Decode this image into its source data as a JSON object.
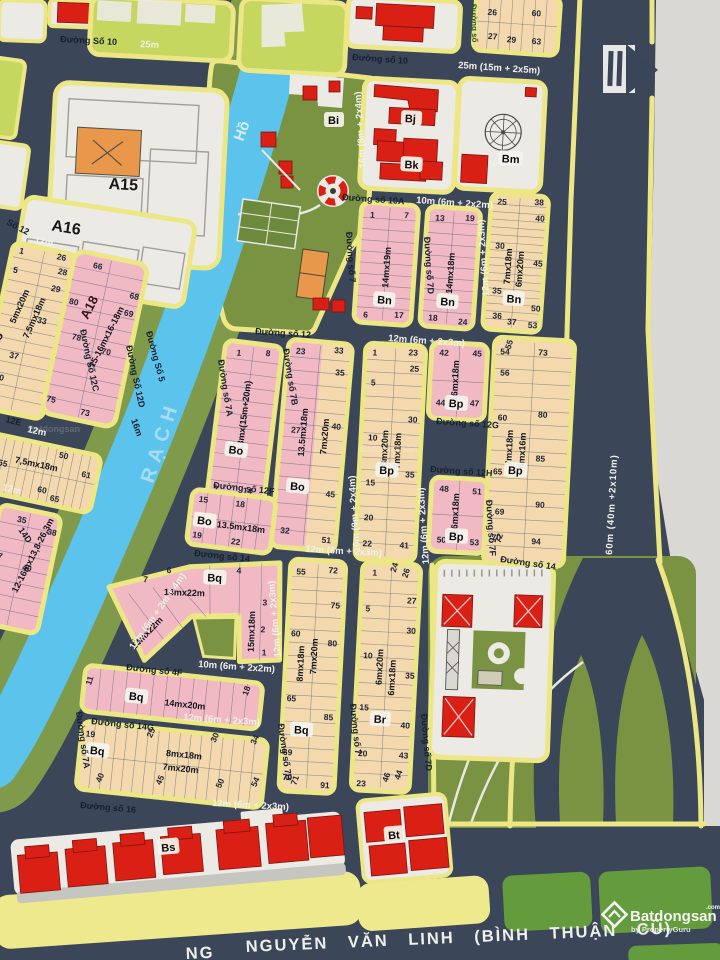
{
  "streets": {
    "s10": "Đường Số 10",
    "s10m": "Đường số 10",
    "s10A": "Đường số 10A",
    "s12": "Đường số 12",
    "s12C": "Đường Số 12C",
    "s12D": "Đường Số 12D",
    "s12E": "12E",
    "s12F": "Đường số 12F",
    "s12G": "Đường số 12G",
    "s12H": "Đường số 12H",
    "s14": "Đường số 14",
    "s14D": "14D",
    "s14G": "Đường số 14G",
    "s16": "Đường số 16",
    "s4F": "Đường số 4F",
    "s5": "Đường Số 5",
    "s7": "Đường số 7",
    "s7A": "Đường số 7A",
    "s7B": "Đường số 7B",
    "s7D": "Đường số 7D",
    "s7F": "Đường số 7F",
    "s9": "Đường số",
    "so12": "Số 12"
  },
  "widths": {
    "w25": "25m",
    "w25s": "25m (15m + 2x5m)",
    "w10": "10m (6m + 2x2m)",
    "w12s": "12m (6m + 2x3m)",
    "w16s": "16m (8m + 2x4m)",
    "w12r": "12m (6m + 2m + 4m)",
    "w12": "12m",
    "w16": "16m",
    "w60": "60m (40m +2x10m)"
  },
  "river": {
    "rach": "RẠCH",
    "ho": "Hồ"
  },
  "avenue": {
    "prefix": "NG",
    "name": "NGUYỄN VĂN LINH (BÌNH THUẬN CŨ)"
  },
  "watermark": {
    "brand": "Batdongsan",
    "tld": ".com.vn",
    "byline": "by PropertyGuru"
  },
  "colors": {
    "road": "#3b4759",
    "border": "#ece685",
    "pink": "#f0b9c3",
    "tan": "#f3d9ad",
    "water": "#5cc3ec",
    "park": "#7a9342",
    "red": "#da1f14",
    "gray": "#d9d8d4"
  },
  "blocks": {
    "a15": {
      "label": "A15"
    },
    "a16": {
      "label": "A16"
    },
    "a18n": {
      "label": "A18",
      "size1": "5mx20m",
      "size2": "7,5mx18m",
      "numbers": [
        "1",
        "26",
        "28",
        "29",
        "33",
        "5",
        "37",
        "40"
      ]
    },
    "a18e": {
      "label": "A18",
      "size1": "15-16mx16-18m",
      "numbers": [
        "66",
        "68",
        "80",
        "69",
        "78",
        "70",
        "75",
        "73"
      ]
    },
    "a18s": {
      "size1": "12-16mx13,8-26,3m",
      "numbers": [
        "35",
        "38",
        "37",
        "40",
        "41",
        "43"
      ]
    },
    "row75": {
      "size1": "7,5mx18m",
      "numbers": [
        "50",
        "61",
        "55",
        "60",
        "65"
      ]
    },
    "tr": {
      "numbers": [
        "26",
        "60",
        "27",
        "29",
        "63"
      ]
    },
    "bi": {
      "label": "Bi"
    },
    "bj": {
      "label": "Bj"
    },
    "bk": {
      "label": "Bk"
    },
    "bm": {
      "label": "Bm"
    },
    "bn1": {
      "label": "Bn",
      "size1": "14mx19m",
      "numbers": [
        "1",
        "7",
        "6",
        "17"
      ]
    },
    "bn2": {
      "label": "Bn",
      "size1": "14mx18m",
      "numbers": [
        "13",
        "19",
        "18",
        "24"
      ]
    },
    "bn3": {
      "label": "Bn",
      "size1": "7mx18m",
      "size2": "6mx20m",
      "numbers": [
        "25",
        "38",
        "40",
        "30",
        "45",
        "35",
        "50",
        "36",
        "37",
        "53"
      ]
    },
    "bo1": {
      "label": "Bo",
      "size1": "13mx(15m+20m)",
      "numbers": [
        "1",
        "8",
        "7",
        "14"
      ]
    },
    "bo2": {
      "label": "Bo",
      "size1": "13.5mx18m",
      "size2": "7mx20m",
      "numbers": [
        "23",
        "33",
        "35",
        "27",
        "40",
        "45",
        "32",
        "51"
      ]
    },
    "bo3": {
      "label": "Bo",
      "size1": "13.5mx18m",
      "numbers": [
        "15",
        "18",
        "19",
        "22"
      ]
    },
    "bp1": {
      "label": "Bp",
      "size1": "8mx20m",
      "size2": "7mx18m",
      "numbers": [
        "1",
        "23",
        "25",
        "5",
        "30",
        "10",
        "35",
        "15",
        "20",
        "22",
        "41"
      ]
    },
    "bp2": {
      "label": "Bp",
      "size1": "16mx18m",
      "numbers": [
        "42",
        "45",
        "44",
        "47"
      ]
    },
    "bp3": {
      "label": "Bp",
      "size1": "16mx18m",
      "numbers": [
        "48",
        "51",
        "50",
        "53"
      ]
    },
    "bp4": {
      "label": "Bp",
      "size1": "7mx18m",
      "size2": "6mx16m",
      "numbers": [
        "54",
        "55",
        "73",
        "56",
        "60",
        "80",
        "65",
        "85",
        "69",
        "90",
        "70",
        "72",
        "94"
      ]
    },
    "bqL": {
      "label": "Bq",
      "size1": "14mx22m",
      "size2": "14mx22m",
      "size3": "15mx18m",
      "numbers": [
        "6",
        "7",
        "4",
        "3",
        "2",
        "1",
        "10"
      ]
    },
    "bqS": {
      "label": "Bq",
      "size1": "14mx20m",
      "numbers": [
        "11",
        "18"
      ]
    },
    "bqT": {
      "label": "Bq",
      "size1": "8mx18m",
      "size2": "7mx20m",
      "numbers": [
        "19",
        "25",
        "30",
        "34",
        "40",
        "45",
        "50",
        "54"
      ]
    },
    "bqE": {
      "label": "Bq",
      "size1": "8mx18m",
      "size2": "7mx20m",
      "numbers": [
        "55",
        "72",
        "75",
        "60",
        "80",
        "65",
        "85",
        "69",
        "70",
        "71",
        "91"
      ]
    },
    "br": {
      "label": "Br",
      "size1": "6mx20m",
      "size2": "6mx18m",
      "numbers": [
        "1",
        "24",
        "26",
        "27",
        "5",
        "30",
        "10",
        "35",
        "15",
        "40",
        "20",
        "43",
        "44",
        "23",
        "46"
      ]
    },
    "bs": {
      "label": "Bs"
    },
    "bt": {
      "label": "Bt"
    }
  }
}
